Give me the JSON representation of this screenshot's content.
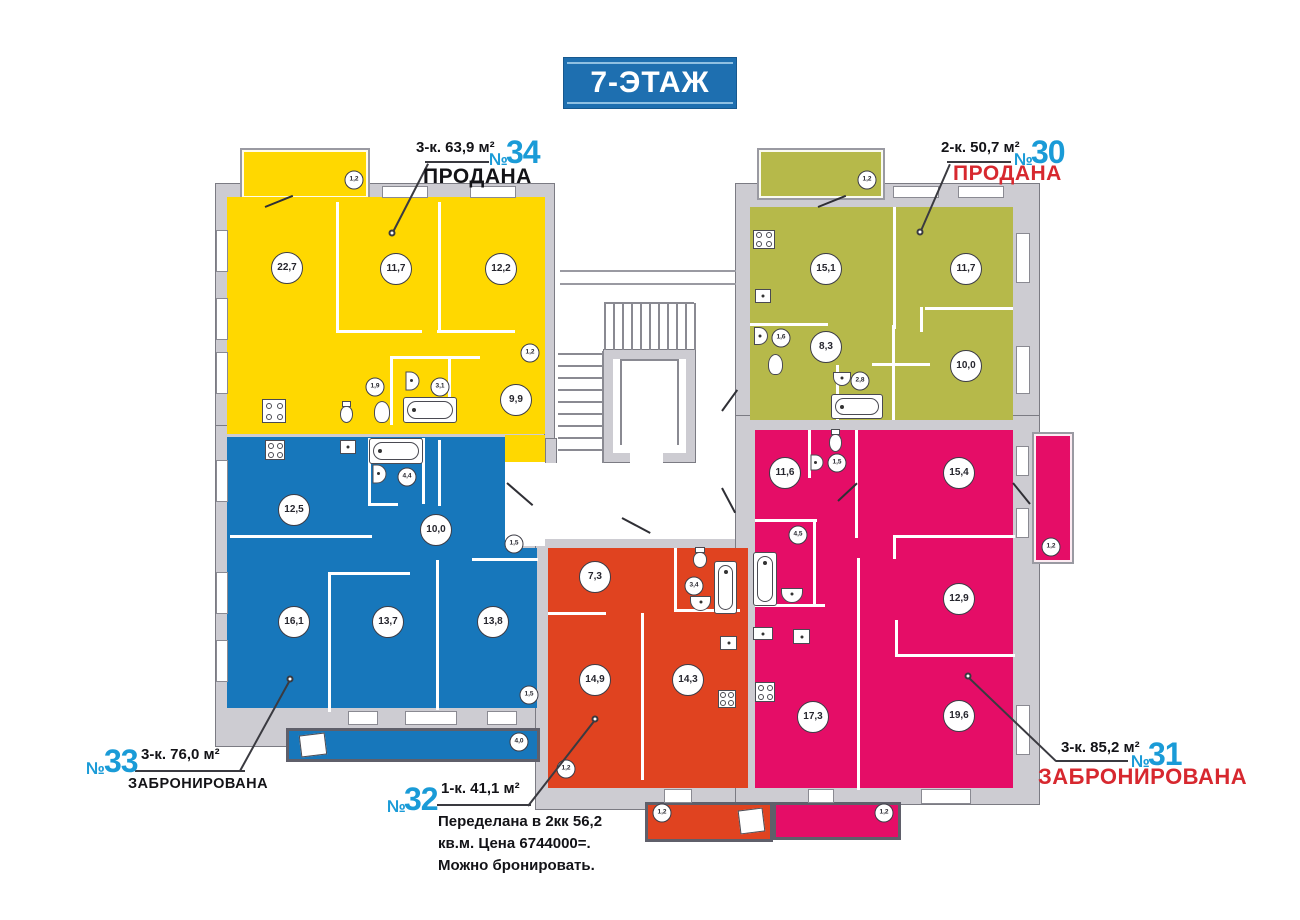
{
  "title": "7-ЭТАЖ",
  "no_sign": "№",
  "colors": {
    "yellow": "#ffd800",
    "olive": "#b6b94a",
    "blue": "#1777bb",
    "red": "#e04320",
    "pink": "#e50d67",
    "accent_blue": "#1a9bd7",
    "status_red": "#d7282f",
    "wall_gray": "#cdccd2",
    "banner_blue": "#1e6fb0"
  },
  "apartments": {
    "a34": {
      "num": "34",
      "area_label": "3-к. 63,9 м²",
      "status": "ПРОДАНА",
      "rooms": [
        "22,7",
        "11,7",
        "12,2",
        "1,2",
        "1,9",
        "3,1",
        "9,9"
      ],
      "balcony": "1,2"
    },
    "a30": {
      "num": "30",
      "area_label": "2-к. 50,7 м²",
      "status": "ПРОДАНА",
      "rooms": [
        "15,1",
        "11,7",
        "1,6",
        "8,3",
        "2,8",
        "10,0"
      ],
      "balcony": "1,2"
    },
    "a33": {
      "num": "33",
      "area_label": "3-к. 76,0 м²",
      "status": "ЗАБРОНИРОВАНА",
      "rooms": [
        "12,5",
        "4,4",
        "10,0",
        "1,5",
        "16,1",
        "13,7",
        "13,8",
        "1,5"
      ],
      "balcony": "4,0"
    },
    "a32": {
      "num": "32",
      "area_label": "1-к. 41,1 м²",
      "note1": "Переделана в 2кк 56,2",
      "note2": "кв.м. Цена 6744000=.",
      "note3": "Можно бронировать.",
      "rooms": [
        "7,3",
        "3,4",
        "14,9",
        "14,3",
        "1,2"
      ],
      "balcony": "1,2"
    },
    "a31": {
      "num": "31",
      "area_label": "3-к. 85,2 м²",
      "status": "ЗАБРОНИРОВАНА",
      "rooms": [
        "11,6",
        "1,5",
        "15,4",
        "4,5",
        "12,9",
        "17,3",
        "19,6"
      ],
      "balcony_right": "1,2",
      "balcony_bottom": "1,2"
    }
  }
}
